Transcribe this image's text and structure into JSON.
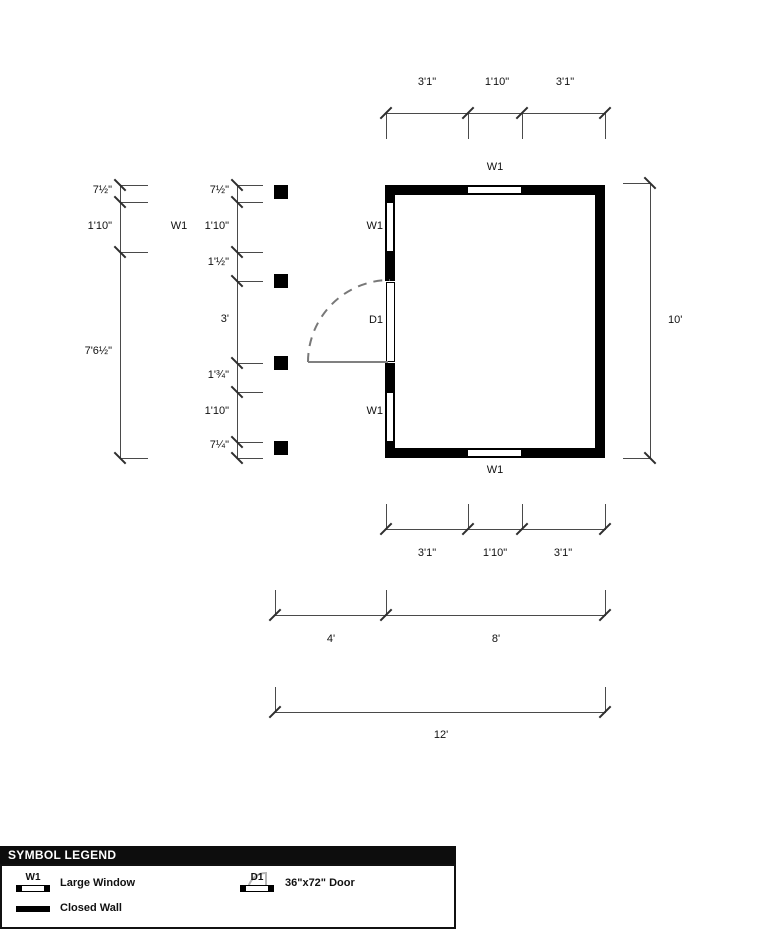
{
  "colors": {
    "wall": "#000000",
    "dim_line": "#4a4a4a",
    "door_swing": "#787878",
    "legend_header_bg": "#0d0d0d",
    "legend_header_text": "#ffffff"
  },
  "floorplan": {
    "window_label": "W1",
    "door_label": "D1",
    "dim_top": [
      "3'1\"",
      "1'10\"",
      "3'1\""
    ],
    "dim_bottom": [
      "3'1\"",
      "1'10\"",
      "3'1\""
    ],
    "dim_right": "10'",
    "dim_bottom_split": [
      "4'",
      "8'"
    ],
    "dim_bottom_total": "12'",
    "dim_left_outer": [
      "7½\"",
      "1'10\"",
      "7'6½\""
    ],
    "dim_left_inner": [
      "7½\"",
      "1'10\"",
      "1'½\"",
      "3'",
      "1'¾\"",
      "1'10\"",
      "7¼\""
    ]
  },
  "legend": {
    "title": "SYMBOL LEGEND",
    "items": [
      {
        "code": "W1",
        "label": "Large Window"
      },
      {
        "code": "D1",
        "label": "36\"x72\" Door"
      },
      {
        "code": "",
        "label": "Closed Wall"
      }
    ]
  }
}
